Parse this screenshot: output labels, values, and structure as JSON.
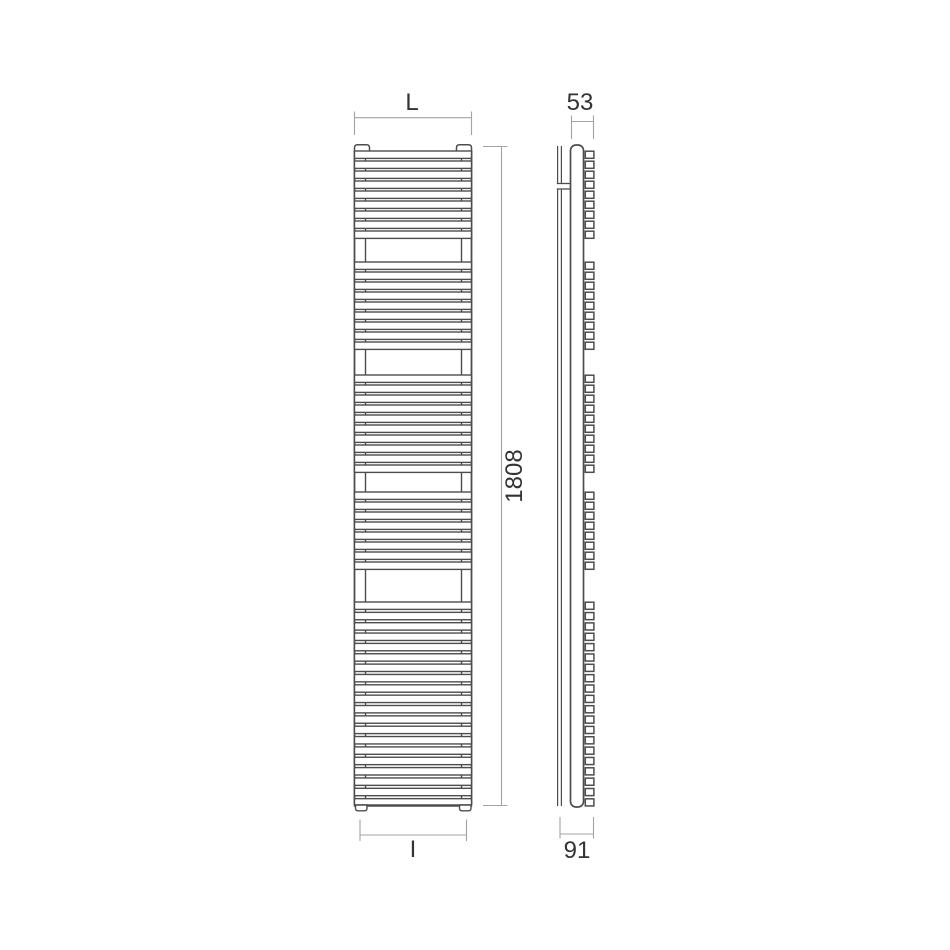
{
  "page": {
    "background": "#ffffff"
  },
  "drawing": {
    "kind": "towel-radiator technical dimension drawing",
    "views": {
      "front": {
        "name": "front elevation",
        "bar_groups": [
          9,
          9,
          10,
          8,
          20
        ],
        "collector_caps": 2,
        "feet": 2
      },
      "side": {
        "name": "side profile",
        "bar_end_groups": [
          9,
          9,
          10,
          8,
          20
        ],
        "wall_bracket_count": 1
      }
    },
    "dimensions": {
      "width": {
        "label": "L"
      },
      "depth_top": {
        "label": "53"
      },
      "height": {
        "label": "1808"
      },
      "connection_width": {
        "label": "I"
      },
      "depth_bottom": {
        "label": "91"
      }
    },
    "colors": {
      "object_line": "#4d4d4d",
      "dimension_line": "#a3a3a3",
      "label_text": "#333333",
      "background": "#ffffff"
    }
  }
}
